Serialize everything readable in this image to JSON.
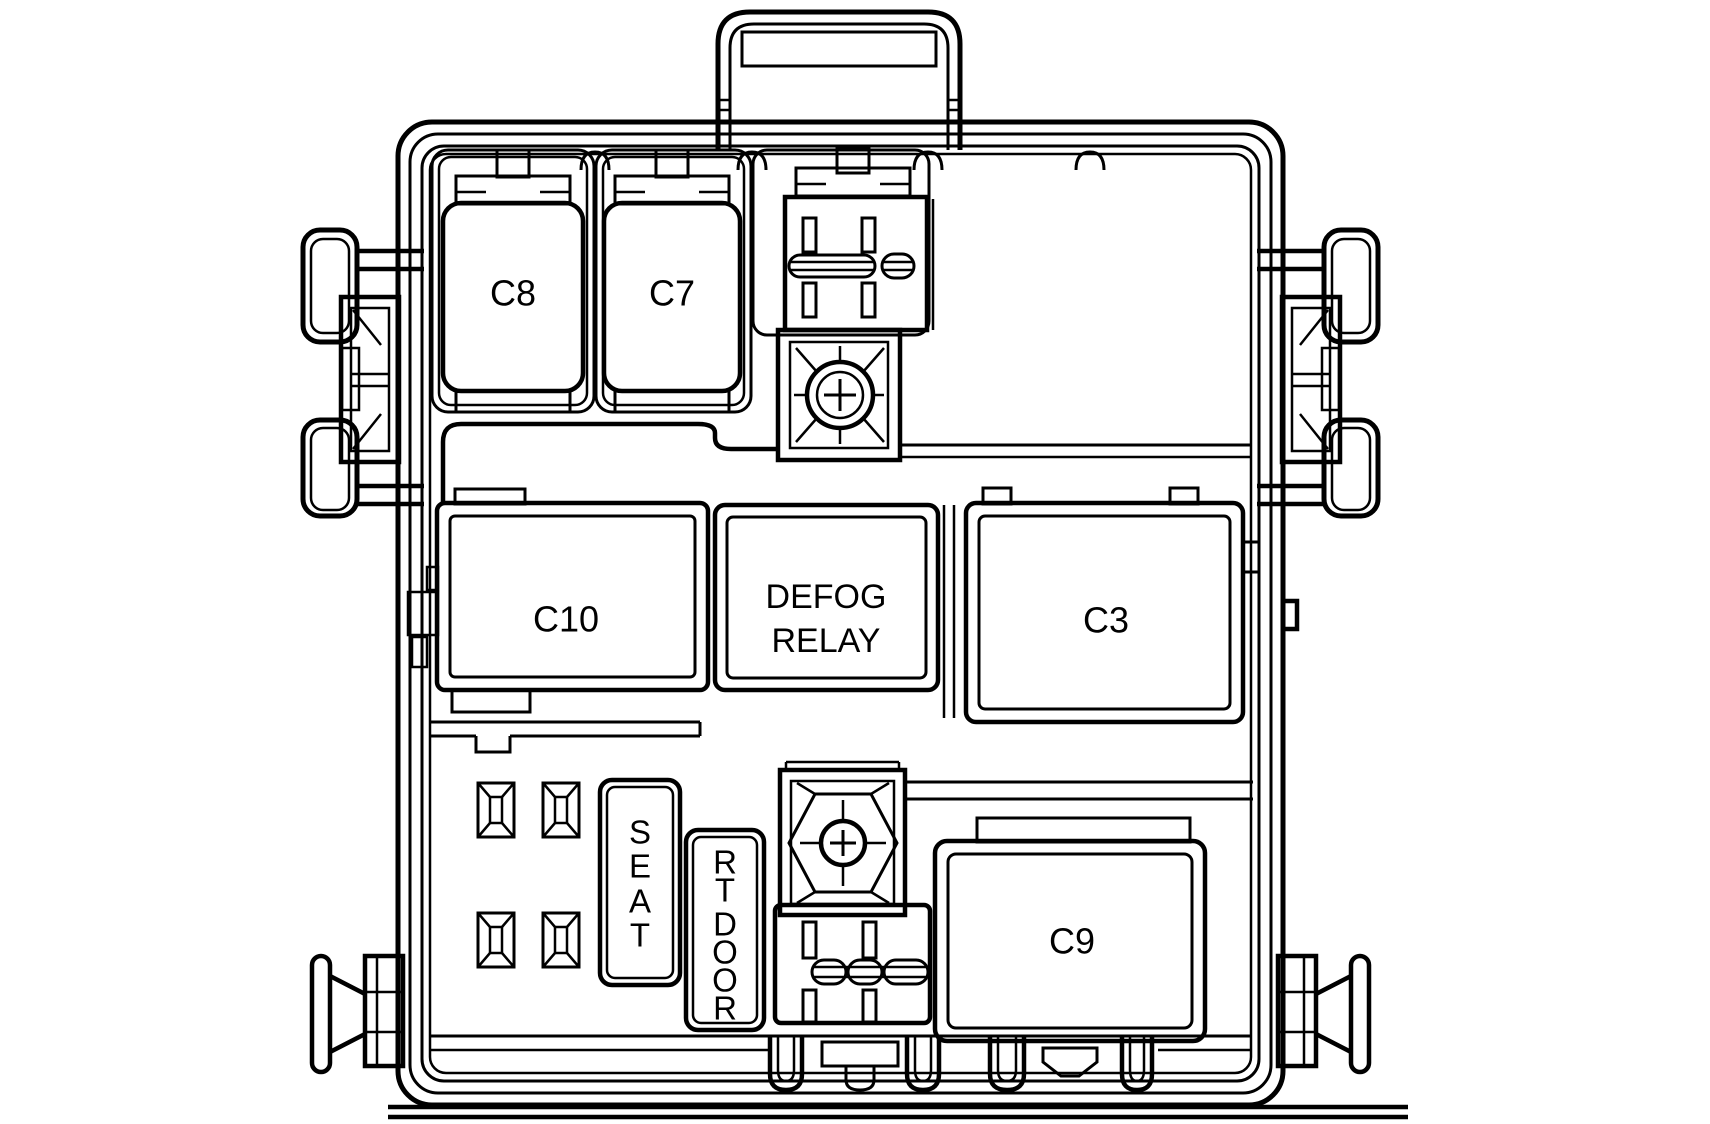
{
  "colors": {
    "line": "#000000",
    "background": "#ffffff"
  },
  "labels": {
    "c8": "C8",
    "c7": "C7",
    "c5": "C5",
    "c4": "C4",
    "c10": "C10",
    "defog_relay": [
      "DEFOG",
      "RELAY"
    ],
    "c3": "C3",
    "c9": "C9",
    "seat": "SEAT",
    "seat_letters": [
      "S",
      "E",
      "A",
      "T"
    ],
    "rt_door": "RT DOOR",
    "rt_door_letters": [
      "R",
      "T",
      "D",
      "O",
      "O",
      "R"
    ]
  }
}
